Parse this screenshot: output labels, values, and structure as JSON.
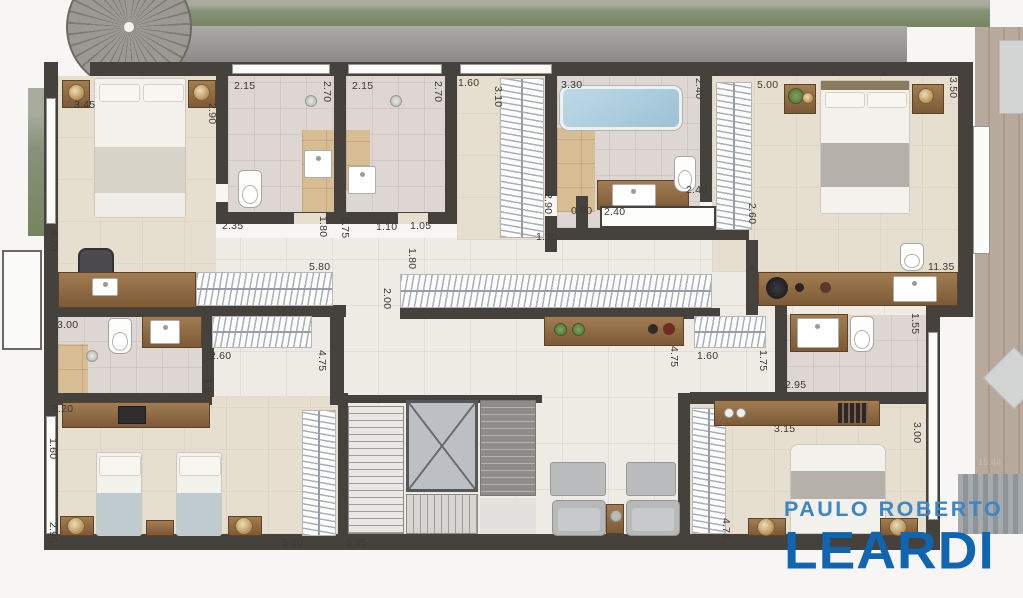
{
  "meta": {
    "kind": "residential floor plan rendering (upper floor)"
  },
  "palette": {
    "wall": "#45423e",
    "floor_bedroom": "#e6dfd0",
    "floor_bath": "#ddd6d2",
    "floor_hall": "#edebe4",
    "accent_tile": "#d7bd93",
    "wood": "#8f6b44",
    "tub_blue": "#a9cde0",
    "garden_green": "#75855e",
    "deck_wood": "#b3a79a",
    "logo_light": "#3d86c6",
    "logo_dark": "#0f65af"
  },
  "logo": {
    "line1": "PAULO ROBERTO",
    "line2": "LEARDI"
  },
  "dimensions": [
    {
      "v": "3.45",
      "x": 74,
      "y": 99
    },
    {
      "v": "2.90",
      "x": 206,
      "y": 103,
      "r": 1
    },
    {
      "v": "4.70",
      "x": 48,
      "y": 230,
      "r": 1
    },
    {
      "v": "2.15",
      "x": 234,
      "y": 80
    },
    {
      "v": "2.70",
      "x": 321,
      "y": 81,
      "r": 1
    },
    {
      "v": "2.35",
      "x": 222,
      "y": 220
    },
    {
      "v": "2.15",
      "x": 352,
      "y": 80
    },
    {
      "v": "2.70",
      "x": 432,
      "y": 81,
      "r": 1
    },
    {
      "v": "1.80",
      "x": 317,
      "y": 216,
      "r": 1
    },
    {
      "v": "0.75",
      "x": 339,
      "y": 217,
      "r": 1
    },
    {
      "v": "1.10",
      "x": 376,
      "y": 221
    },
    {
      "v": "1.05",
      "x": 410,
      "y": 220
    },
    {
      "v": "1.60",
      "x": 458,
      "y": 77
    },
    {
      "v": "3.10",
      "x": 492,
      "y": 86,
      "r": 1
    },
    {
      "v": "3.30",
      "x": 561,
      "y": 79
    },
    {
      "v": "2.40",
      "x": 693,
      "y": 78,
      "r": 1
    },
    {
      "v": "2.90",
      "x": 542,
      "y": 193,
      "r": 1
    },
    {
      "v": "0.90",
      "x": 571,
      "y": 205
    },
    {
      "v": "2.40",
      "x": 604,
      "y": 206
    },
    {
      "v": "2.40",
      "x": 686,
      "y": 184
    },
    {
      "v": "1.30",
      "x": 536,
      "y": 231
    },
    {
      "v": "5.00",
      "x": 757,
      "y": 79
    },
    {
      "v": "3.50",
      "x": 947,
      "y": 77,
      "r": 1
    },
    {
      "v": "2.60",
      "x": 746,
      "y": 203,
      "r": 1
    },
    {
      "v": "5.80",
      "x": 309,
      "y": 261
    },
    {
      "v": "1.80",
      "x": 406,
      "y": 248,
      "r": 1
    },
    {
      "v": "2.00",
      "x": 381,
      "y": 288,
      "r": 1
    },
    {
      "v": "11.35",
      "x": 928,
      "y": 261
    },
    {
      "v": "3.00",
      "x": 57,
      "y": 319
    },
    {
      "v": "1.60",
      "x": 47,
      "y": 438,
      "r": 1
    },
    {
      "v": "2.60",
      "x": 210,
      "y": 350
    },
    {
      "v": "1.80",
      "x": 201,
      "y": 378,
      "r": 1
    },
    {
      "v": "4.75",
      "x": 316,
      "y": 350,
      "r": 1
    },
    {
      "v": "4.75",
      "x": 668,
      "y": 346,
      "r": 1
    },
    {
      "v": "1.60",
      "x": 697,
      "y": 350
    },
    {
      "v": "1.75",
      "x": 757,
      "y": 350,
      "r": 1
    },
    {
      "v": "1.55",
      "x": 909,
      "y": 313,
      "r": 1
    },
    {
      "v": "2.95",
      "x": 785,
      "y": 379
    },
    {
      "v": "3.20",
      "x": 52,
      "y": 403
    },
    {
      "v": "2.95",
      "x": 47,
      "y": 522,
      "r": 1
    },
    {
      "v": "3.15",
      "x": 774,
      "y": 423
    },
    {
      "v": "3.00",
      "x": 911,
      "y": 422,
      "r": 1
    },
    {
      "v": "5.80",
      "x": 282,
      "y": 537
    },
    {
      "v": "6.95",
      "x": 346,
      "y": 537
    },
    {
      "v": "4.75",
      "x": 720,
      "y": 518,
      "r": 1
    },
    {
      "v": "15.44",
      "x": 978,
      "y": 457,
      "f": 1
    }
  ]
}
